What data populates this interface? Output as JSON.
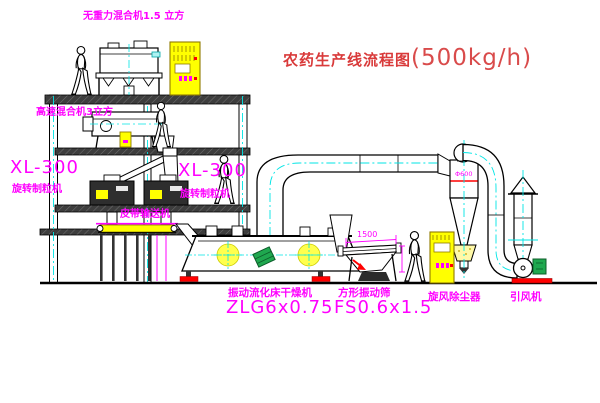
{
  "title": {
    "name": "农药生产线流程图",
    "capacity": "(500kg/h)"
  },
  "labels": {
    "gravity_mixer": "无重力混合机1.5 立方",
    "high_speed_mixer": "高速混合机3立方",
    "granulator_left_model": "XL-300",
    "granulator_left_name": "旋转制粒机",
    "granulator_mid_model": "XL-300",
    "granulator_mid_name": "旋转制粒机",
    "belt_conveyor": "皮带输送机",
    "fluid_bed_dryer_name": "振动流化床干燥机",
    "fluid_bed_dryer_model": "ZLG6x0.75",
    "square_sieve_name": "方形振动筛",
    "square_sieve_model": "FS0.6x1.5",
    "cyclone": "旋风除尘器",
    "induced_draft_fan": "引风机",
    "cyclone_dimension": "Φ600",
    "sieve_dimension": "1500"
  },
  "colors": {
    "label_magenta": "#ff00ff",
    "title_red": "#d93a3a",
    "equipment_yellow": "#ffff00",
    "centerline_cyan": "#00e5e5",
    "motor_green": "#1fa84f",
    "accent_red": "#ff0000",
    "line_black": "#000000",
    "background": "#ffffff"
  }
}
